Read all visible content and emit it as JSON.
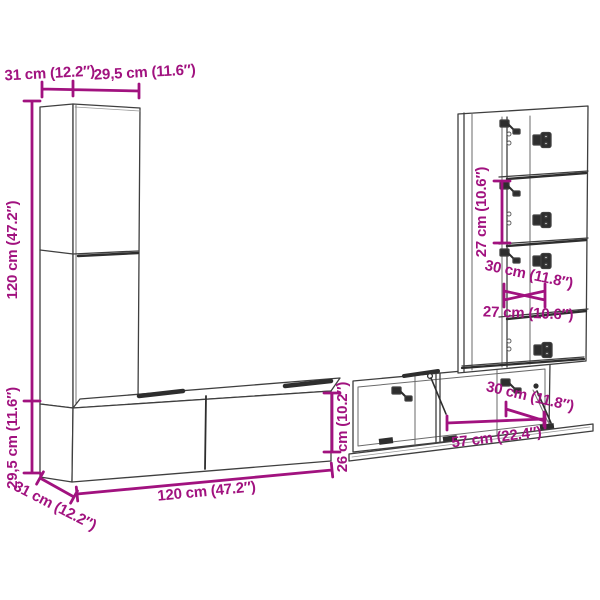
{
  "diagram": {
    "accent_color": "#A1127F",
    "line_color": "#3F3F3F",
    "shadow_color": "#2E2E2E",
    "background_color": "#FFFFFF",
    "dimensions": {
      "top_depth": "31 cm (12.2″)",
      "top_width": "29,5 cm (11.6″)",
      "left_height": "120 cm (47.2″)",
      "left_lower_height": "29,5 cm (11.6″)",
      "bottom_depth": "31 cm (12.2″)",
      "bottom_length": "120 cm (47.2″)",
      "center_height": "26 cm (10.2″)",
      "flap_width": "57 cm (22.4″)",
      "flap_depth": "30 cm (11.8″)",
      "right_compartment_height": "27 cm (10.6″)",
      "right_depth": "30 cm (11.8″)",
      "right_width": "27 cm (10.6″)"
    }
  }
}
